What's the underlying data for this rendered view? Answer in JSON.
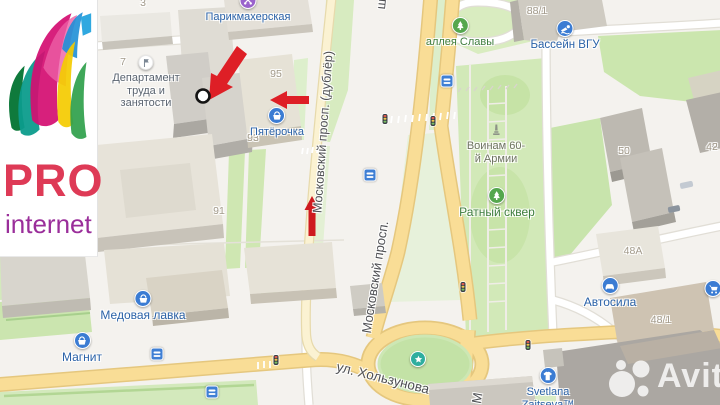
{
  "logo": {
    "title": "PRO",
    "subtitle": "internet"
  },
  "watermark": {
    "brand": "Avito"
  },
  "streets": {
    "moskovsky_dubler": "Московский просп. (дублёр)",
    "moskovsky": "Московский просп.",
    "moskovsky_partial_top": "ш",
    "moskovsky_partial_south": "М",
    "kholzunova": "ул. Хользунова"
  },
  "pois": {
    "hairdresser": "Парикмахерская",
    "department_1": "Департамент",
    "department_2": "труда и",
    "department_3": "занятости",
    "pyaterochka": "Пятёрочка",
    "alley": "аллея Славы",
    "pool": "Бассейн ВГУ",
    "voinam_1": "Воинам 60-",
    "voinam_2": "й Армии",
    "ratny": "Ратный сквер",
    "medovaya": "Медовая лавка",
    "magnit": "Магнит",
    "avtosila": "Автосила",
    "svetlana_1": "Svetlana",
    "svetlana_2": "Zaitseva™"
  },
  "numbers": {
    "n3": "3",
    "n7": "7",
    "n95": "95",
    "n93": "93",
    "n91": "91",
    "n88_1": "88/1",
    "n50": "50",
    "n42": "42",
    "n48a": "48А",
    "n48_1": "48/1"
  },
  "icons": {
    "hairdresser": "scissors-icon",
    "shops": "basket-icon",
    "pool": "swimmer-icon",
    "parks": "tree-icon",
    "monument": "monument-icon",
    "car_service": "car-icon",
    "clothing": "tshirt-icon",
    "hypermarket": "cart-icon",
    "government": "flag-icon",
    "roundabout": "star-icon",
    "bus_stop": "bus-icon",
    "traffic_light": "traffic-light-icon",
    "target": "circle-marker",
    "annotation": "red-arrow"
  },
  "colors": {
    "road_yellow": "#F9DD96",
    "road_dubler": "#FBF2D2",
    "green": "#CFE7B0",
    "poi_blue": "#3B7CD3",
    "annotation_red": "#DE1F26",
    "logo_red": "#DE3A56",
    "logo_purple": "#9A2E9A",
    "star_teal": "#2FAE9F"
  }
}
